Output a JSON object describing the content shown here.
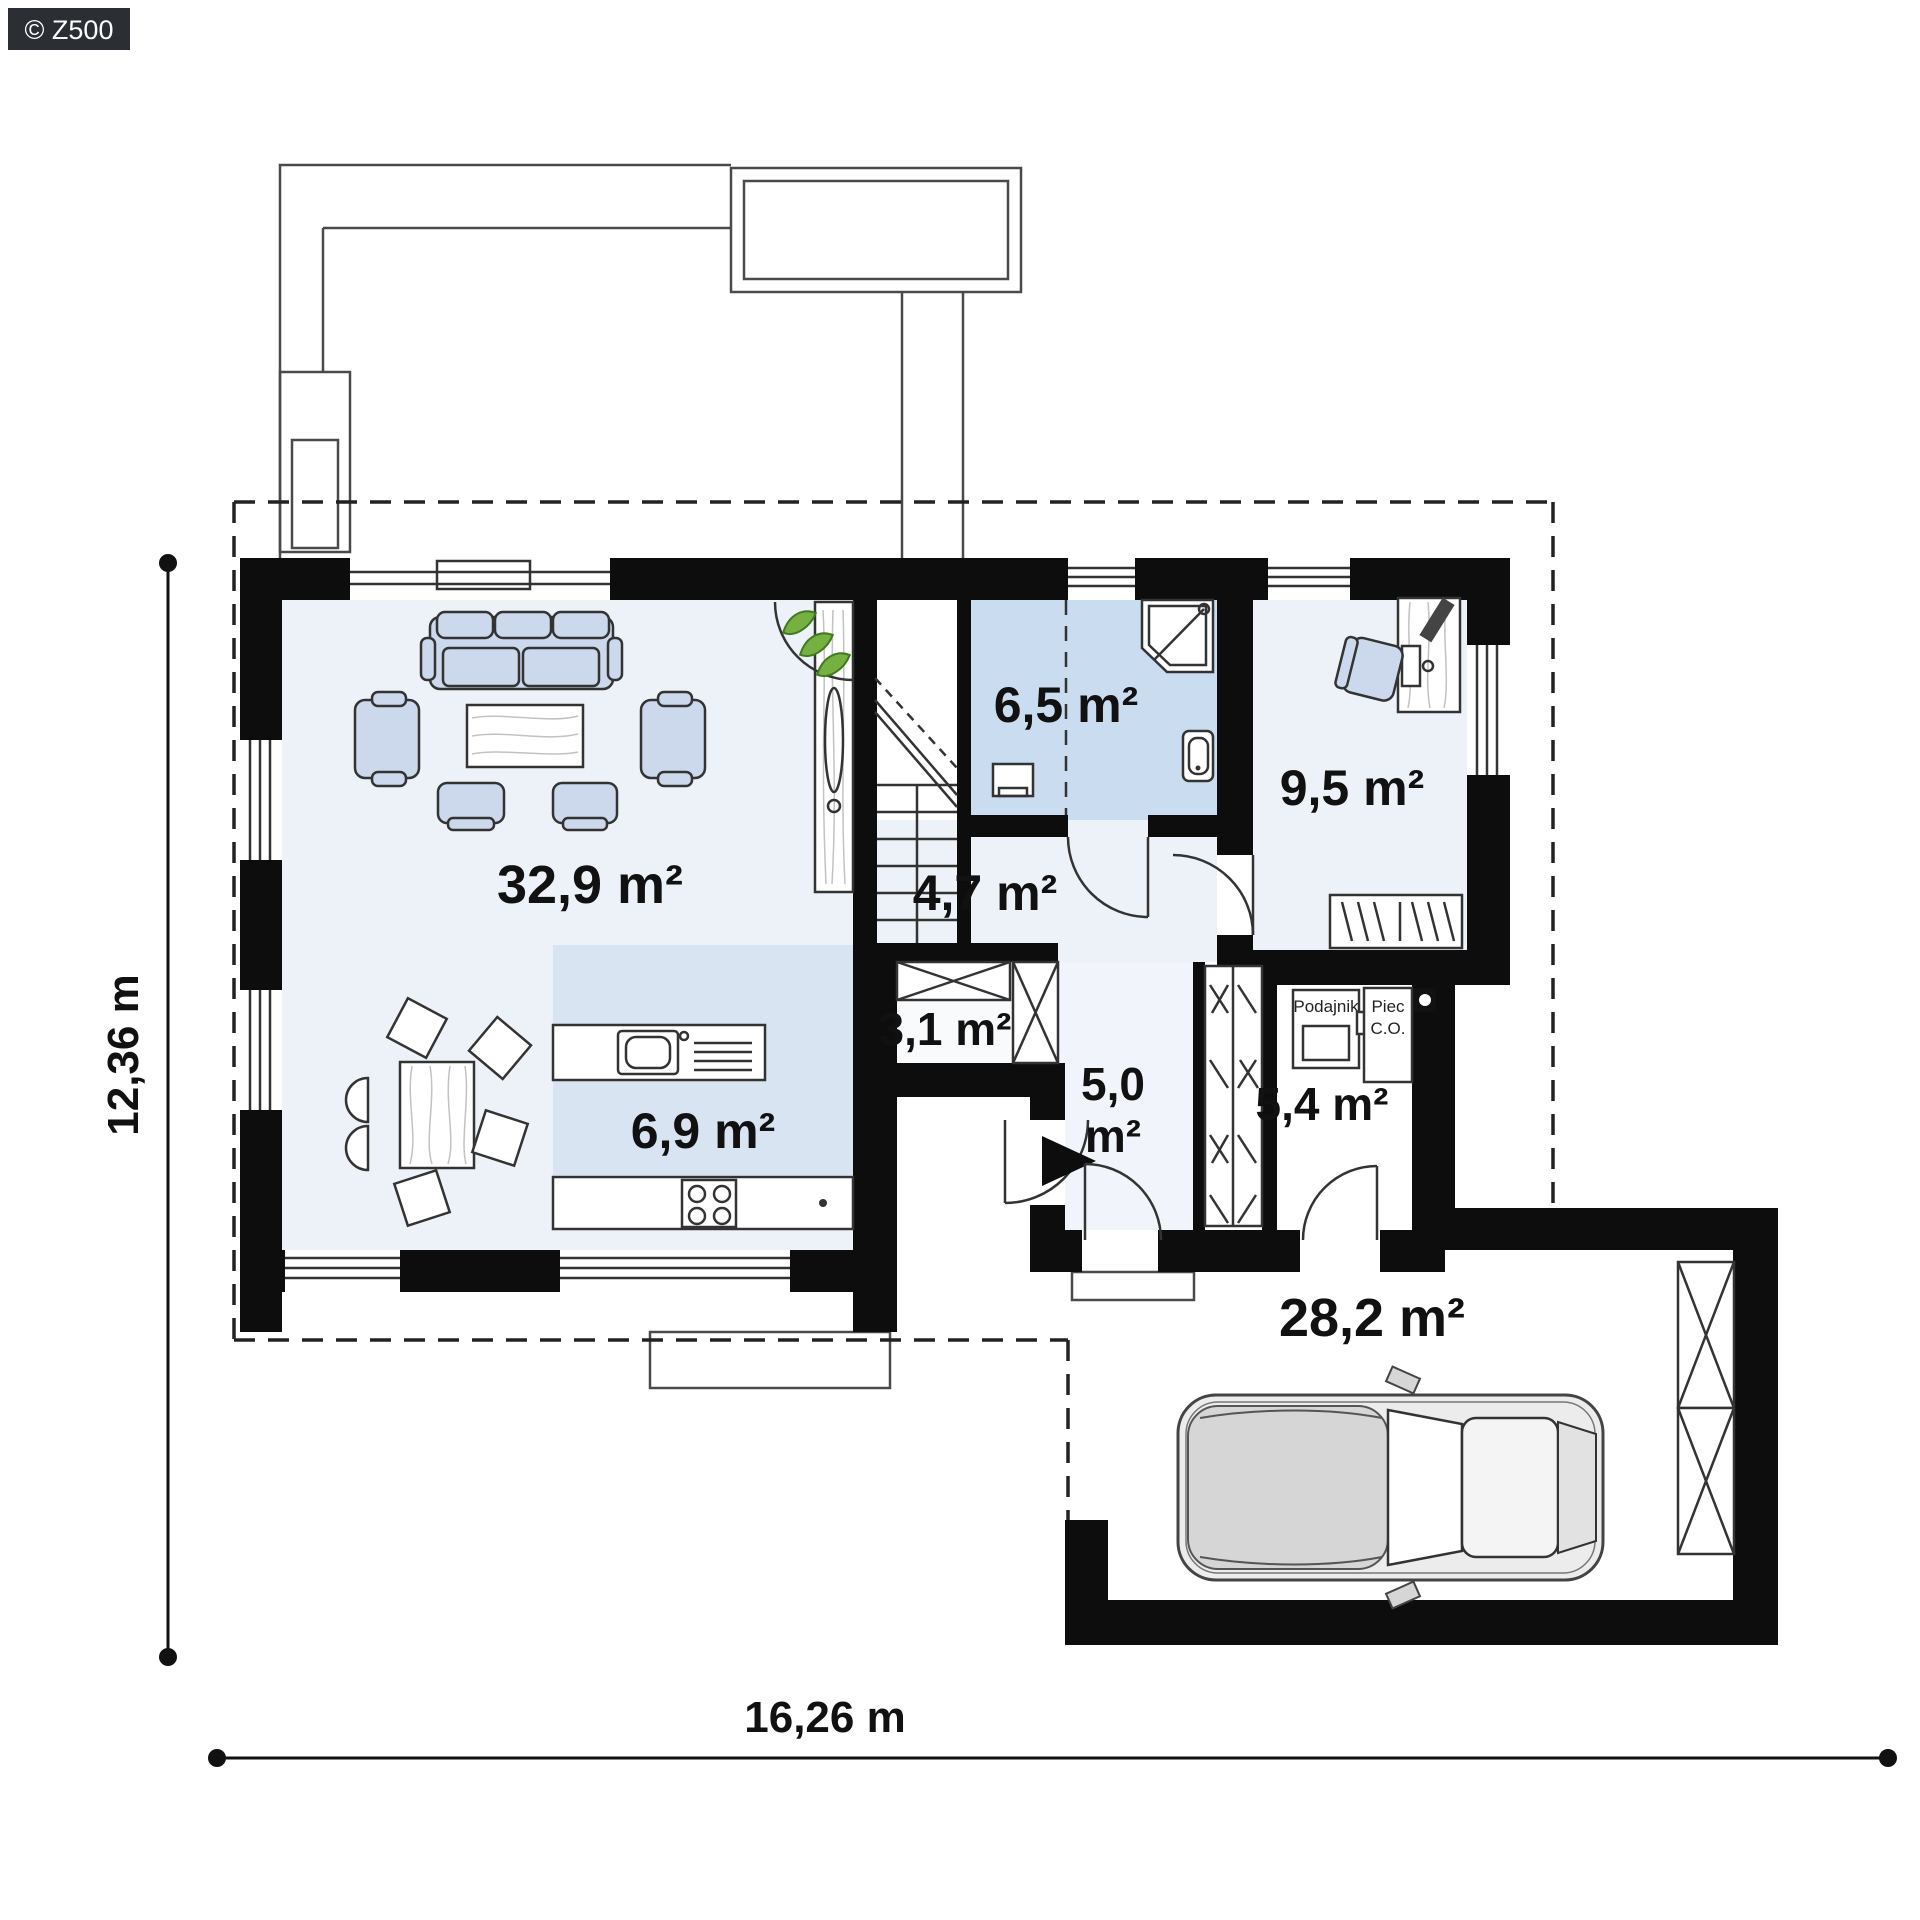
{
  "watermark": {
    "label": "© Z500"
  },
  "plan": {
    "rooms": {
      "living_room": {
        "area_label": "32,9 m²"
      },
      "kitchen": {
        "area_label": "6,9 m²"
      },
      "hall": {
        "area_label": "4,7 m²"
      },
      "bathroom": {
        "area_label": "6,5 m²"
      },
      "office": {
        "area_label": "9,5 m²"
      },
      "pantry": {
        "area_label": "3,1 m²"
      },
      "vestibule": {
        "area_value": "5,0",
        "area_unit": "m²"
      },
      "boiler_room": {
        "area_label": "5,4 m²"
      },
      "garage": {
        "area_label": "28,2 m²"
      }
    },
    "equipment": {
      "feeder_label": "Podajnik",
      "furnace_label_line1": "Piec",
      "furnace_label_line2": "C.O."
    },
    "dimensions": {
      "total_width": "16,26 m",
      "total_height": "12,36 m"
    },
    "colors": {
      "wall": "#0d0d0d",
      "room_tint_light": "#edf2f9",
      "bathroom_tint": "#c9dcf0",
      "kitchen_tint": "#d9e4f3",
      "furniture_fill": "#ccd9ec",
      "plant_green": "#76b041"
    }
  }
}
